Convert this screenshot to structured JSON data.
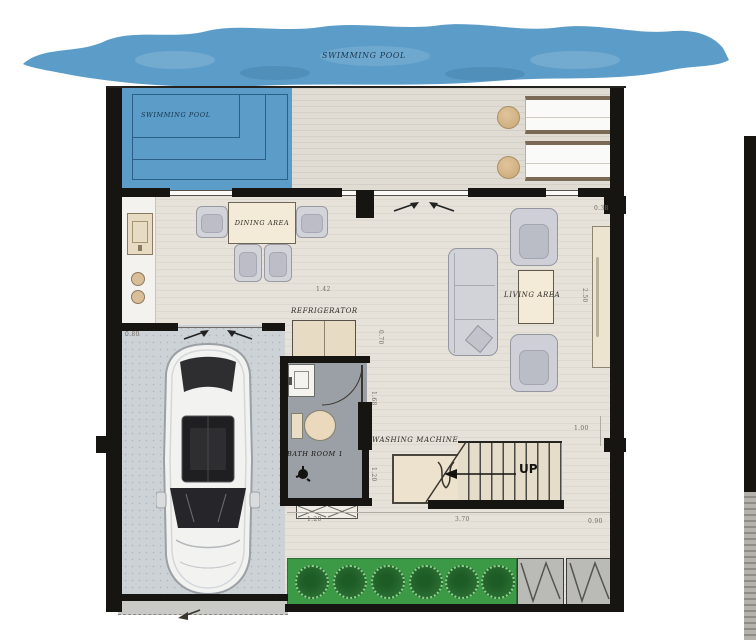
{
  "title": "Ground floor plan",
  "labels": {
    "pool_top": "SWIMMING POOL",
    "pool_inner": "SWIMMING POOL",
    "dining": "DINING AREA",
    "refrigerator": "REFRIGERATOR",
    "living": "LIVING AREA",
    "bathroom": "BATH ROOM 1",
    "washing": "WASHING MACHINE",
    "up": "UP"
  },
  "dimensions": {
    "d142": "1.42",
    "d038": "0.38",
    "d250": "2.50",
    "d070": "0.70",
    "d080": "0.80",
    "d168": "1.68",
    "d120a": "1.20",
    "d120b": "1.20",
    "d370": "3.70",
    "d090": "0.90",
    "d100": "1.00"
  },
  "colors": {
    "pool_water": "#5b9cc9",
    "pool_line": "#2c5f85",
    "wall": "#171512",
    "floor": "#e6e1d9",
    "deck": "#e0dcd4",
    "garage_floor": "#cdd2d7",
    "bathroom_floor": "#9aa0a5",
    "planter": "#3c9a47",
    "bush": "#2a6e31",
    "furniture_gray": "#cfd0d7",
    "table_cream": "#f3ead7",
    "appliance_beige": "#e7dcc3",
    "stair_tread": "#e5dcc9"
  }
}
